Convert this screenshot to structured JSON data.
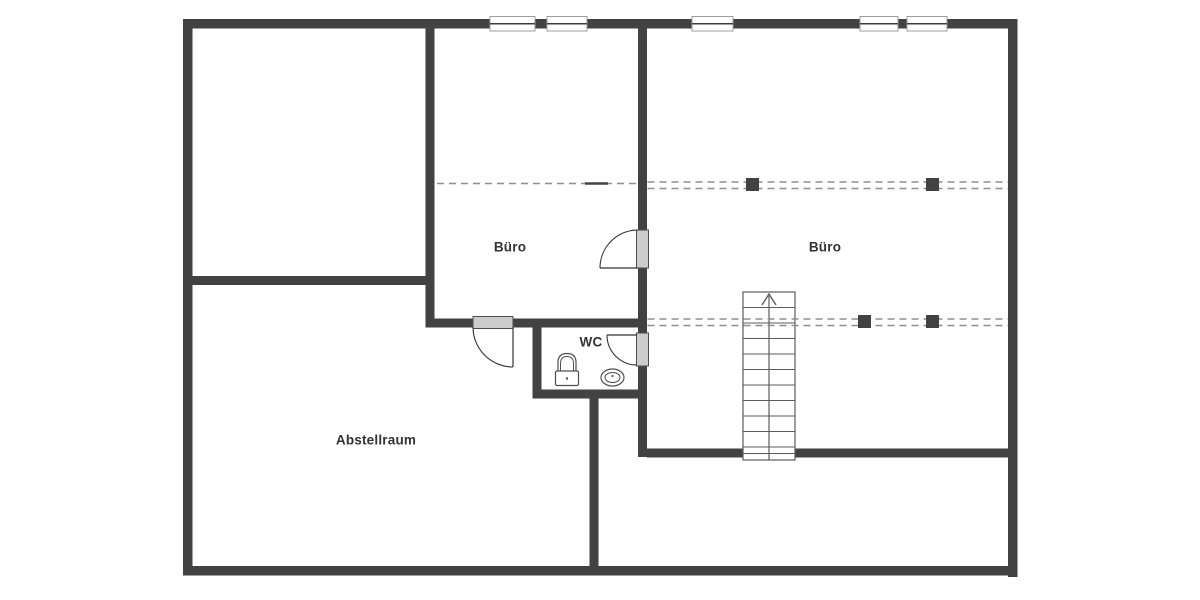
{
  "plan": {
    "type": "floor-plan",
    "canvas": {
      "width": 1200,
      "height": 600,
      "background": "#ffffff"
    },
    "colors": {
      "wall": "#424242",
      "dashed_line": "#8f8f8f",
      "solid_segment": "#424242",
      "post_block": "#424242",
      "door_leaf_fill": "#cccccc",
      "door_leaf_stroke": "#4d4d4d",
      "door_arc": "#333333",
      "window_frame": "#9e9e9e",
      "window_fill": "#ffffff",
      "window_center": "#3d3d3d",
      "stair_stroke": "#5c5c5c",
      "fixture_stroke": "#4f4f4f",
      "label": "#333333"
    },
    "rooms": [
      {
        "id": "buero-1",
        "label": "Büro",
        "cx": 510,
        "cy": 247
      },
      {
        "id": "buero-2",
        "label": "Büro",
        "cx": 825,
        "cy": 247
      },
      {
        "id": "wc",
        "label": "WC",
        "cx": 591,
        "cy": 342
      },
      {
        "id": "abstellraum",
        "label": "Abstellraum",
        "cx": 376,
        "cy": 440
      }
    ],
    "walls": [
      {
        "name": "outer-wall-top",
        "x": 183,
        "y": 19,
        "w": 834.5,
        "h": 9.5
      },
      {
        "name": "outer-wall-left",
        "x": 183,
        "y": 19,
        "w": 9.5,
        "h": 556.5
      },
      {
        "name": "outer-wall-right",
        "x": 1008,
        "y": 19,
        "w": 9.5,
        "h": 558
      },
      {
        "name": "outer-wall-bottom",
        "x": 183,
        "y": 566,
        "w": 834.5,
        "h": 9.5
      },
      {
        "name": "wall-buero1-left-upper",
        "x": 425.5,
        "y": 28,
        "w": 9,
        "h": 299
      },
      {
        "name": "wall-topleft-room-bottom",
        "x": 192,
        "y": 276,
        "w": 242,
        "h": 9
      },
      {
        "name": "wall-center-vertical-a",
        "x": 638,
        "y": 28,
        "w": 9,
        "h": 202
      },
      {
        "name": "wall-center-vertical-b",
        "x": 638,
        "y": 268,
        "w": 9,
        "h": 65
      },
      {
        "name": "wall-center-vertical-c",
        "x": 638,
        "y": 365,
        "w": 9,
        "h": 92
      },
      {
        "name": "wall-buero1-bottom-left",
        "x": 425.5,
        "y": 318.5,
        "w": 47.5,
        "h": 9
      },
      {
        "name": "wall-buero1-bottom-right",
        "x": 513,
        "y": 318.5,
        "w": 125,
        "h": 9
      },
      {
        "name": "wall-wc-left",
        "x": 532.5,
        "y": 327,
        "w": 9,
        "h": 71
      },
      {
        "name": "wall-wc-bottom",
        "x": 532.5,
        "y": 389.5,
        "w": 114.5,
        "h": 9
      },
      {
        "name": "wall-abstellraum-right",
        "x": 589.5,
        "y": 398,
        "w": 9,
        "h": 168
      },
      {
        "name": "wall-buero2-bottom-left",
        "x": 647,
        "y": 448.5,
        "w": 96,
        "h": 9
      },
      {
        "name": "wall-buero2-bottom-right",
        "x": 795,
        "y": 448.5,
        "w": 213,
        "h": 9
      }
    ],
    "windows": [
      {
        "name": "window-1",
        "x": 490,
        "y": 16.5,
        "w": 45,
        "h": 14.5
      },
      {
        "name": "window-2",
        "x": 547,
        "y": 16.5,
        "w": 40,
        "h": 14.5
      },
      {
        "name": "window-3",
        "x": 692,
        "y": 16.5,
        "w": 41,
        "h": 14.5
      },
      {
        "name": "window-4",
        "x": 860,
        "y": 16.5,
        "w": 38,
        "h": 14.5
      },
      {
        "name": "window-5",
        "x": 907,
        "y": 16.5,
        "w": 40,
        "h": 14.5
      }
    ],
    "doors": [
      {
        "name": "door-buero1-buero2",
        "leaf": {
          "x": 636.5,
          "y": 230,
          "w": 12,
          "h": 38
        },
        "panel": [
          600,
          268,
          638,
          268
        ],
        "arc": "M 600 268 A 38 38 0 0 1 638 230"
      },
      {
        "name": "door-buero1-abstellraum",
        "leaf": {
          "x": 473,
          "y": 316.5,
          "w": 40,
          "h": 12
        },
        "panel": [
          513,
          327,
          513,
          367
        ],
        "arc": "M 473 327 A 40 40 0 0 0 513 367"
      },
      {
        "name": "door-wc",
        "leaf": {
          "x": 636.5,
          "y": 333,
          "w": 12,
          "h": 33
        },
        "panel": [
          607,
          335,
          637,
          335
        ],
        "arc": "M 607 335 A 30 30 0 0 0 637 365"
      }
    ],
    "dashed_lines": [
      {
        "name": "knee-wall-buero1",
        "x1": 437,
        "y": 183.5,
        "x2": 636
      },
      {
        "name": "knee-wall-buero2-top-a",
        "x1": 647.5,
        "y": 182,
        "x2": 1008
      },
      {
        "name": "knee-wall-buero2-top-b",
        "x1": 647.5,
        "y": 188.5,
        "x2": 1008
      },
      {
        "name": "knee-wall-buero2-low-a",
        "x1": 647.5,
        "y": 319,
        "x2": 1008
      },
      {
        "name": "knee-wall-buero2-low-b",
        "x1": 647.5,
        "y": 325.5,
        "x2": 1008
      }
    ],
    "solid_segments": [
      {
        "name": "solid-mark-buero1",
        "x1": 585,
        "y": 183.5,
        "x2": 608,
        "thickness": 2.5
      }
    ],
    "post_blocks": [
      {
        "name": "post-1",
        "x": 746,
        "y": 178,
        "w": 13,
        "h": 13
      },
      {
        "name": "post-2",
        "x": 926,
        "y": 178,
        "w": 13,
        "h": 13
      },
      {
        "name": "post-3",
        "x": 858,
        "y": 315,
        "w": 13,
        "h": 13
      },
      {
        "name": "post-4",
        "x": 926,
        "y": 315,
        "w": 13,
        "h": 13
      }
    ],
    "stairs": {
      "x": 743,
      "y": 292,
      "w": 52,
      "h": 168,
      "treads": [
        307.5,
        323,
        338.5,
        354,
        369.5,
        385,
        400.5,
        416,
        431.5,
        447,
        453.5
      ],
      "center_x": 769,
      "arrow": "762,305 769,294 776,305",
      "direction": "up"
    },
    "fixtures": {
      "toilet": {
        "cx": 567,
        "bowl_top": 353.5,
        "bowl_bottom": 371,
        "bowl_halfw": 9,
        "tank": {
          "x": 555.5,
          "y": 371,
          "w": 23,
          "h": 14.5
        },
        "button": {
          "cx": 567,
          "cy": 378.5,
          "r": 1.2
        }
      },
      "sink": {
        "cx": 612.5,
        "cy": 377.5,
        "rx": 11.5,
        "ry": 8.5,
        "inner_rx": 7.5,
        "inner_ry": 5,
        "dot": {
          "cx": 612.5,
          "cy": 376,
          "r": 1.1
        }
      }
    }
  }
}
